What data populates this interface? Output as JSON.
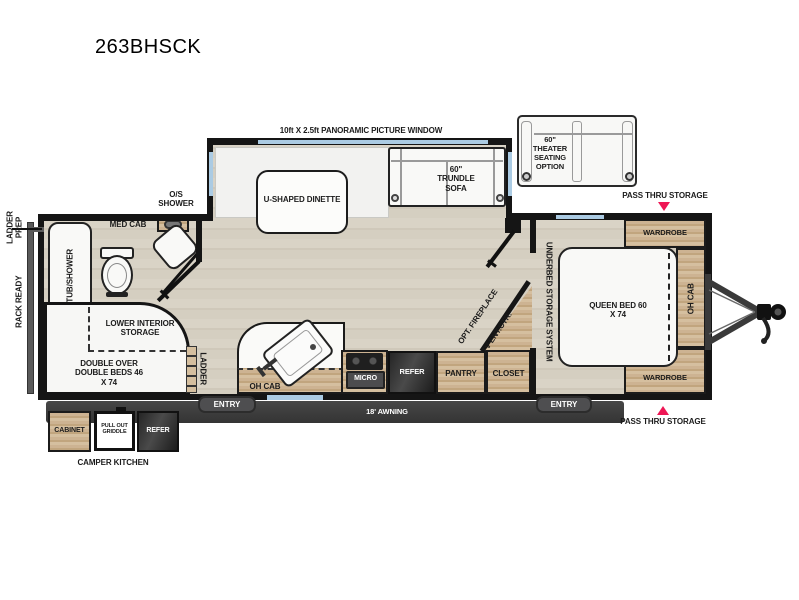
{
  "title": "263BHSCK",
  "labels": {
    "panoramic_window": "10ft X 2.5ft PANORAMIC PICTURE WINDOW",
    "theater_seating": "60\" THEATER SEATING OPTION",
    "pass_thru_top": "PASS THRU STORAGE",
    "pass_thru_bottom": "PASS THRU STORAGE",
    "dinette": "U-SHAPED DINETTE",
    "trundle_sofa": "60\" TRUNDLE SOFA",
    "os_shower": "O/S SHOWER",
    "med_cab": "MED CAB",
    "tub_shower": "TUB/SHOWER",
    "ladder_prep": "LADDER PREP",
    "rack_ready": "RACK READY",
    "lower_interior_storage": "LOWER INTERIOR STORAGE",
    "double_beds": "DOUBLE OVER DOUBLE BEDS 46 X 74",
    "bunk_ladder": "LADDER",
    "oh_cab_kitchen": "OH CAB",
    "micro": "MICRO",
    "refer": "REFER",
    "pantry": "PANTRY",
    "closet": "CLOSET",
    "opt_fireplace": "OPT. FIREPLACE",
    "tv_ent_ctr": "TV ENT.CTR.",
    "underbed_storage": "UNDERBED STORAGE SYSTEM",
    "queen_bed": "QUEEN BED 60 X 74",
    "wardrobe_top": "WARDROBE",
    "wardrobe_bottom": "WARDROBE",
    "oh_cab_bedroom": "OH CAB",
    "entry_left": "ENTRY",
    "entry_right": "ENTRY",
    "awning": "18' AWNING",
    "camper_cabinet": "CABINET",
    "camper_griddle": "PULL OUT GRIDDLE",
    "camper_refer": "REFER",
    "camper_kitchen": "CAMPER KITCHEN"
  },
  "colors": {
    "wall": "#151515",
    "floor_wood": "#d5cfc2",
    "cabinet_wood": "#c9ae8c",
    "window_blue": "#abcbe3",
    "dark_appliance": "#2e2e2e",
    "accent_red": "#ee1755",
    "badge_gray": "#4e4e50"
  }
}
